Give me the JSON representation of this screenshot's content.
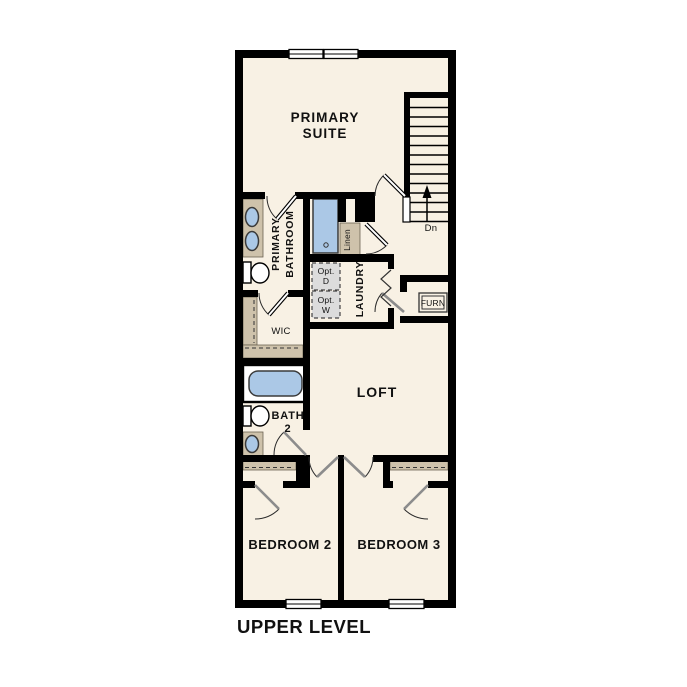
{
  "title": "UPPER LEVEL",
  "colors": {
    "background": "#ffffff",
    "floor": "#f8f1e4",
    "wall": "#000000",
    "counter_tan": "#cec2ab",
    "fixture_blue": "#abc8e6",
    "opt_box_fill": "#dcdcdc",
    "door_leaf_gray": "#8c8c8c"
  },
  "rooms": {
    "primary_suite": {
      "line1": "PRIMARY",
      "line2": "SUITE"
    },
    "primary_bathroom": {
      "line1": "PRIMARY",
      "line2": "BATHROOM"
    },
    "wic": {
      "label": "WIC"
    },
    "laundry": {
      "label": "LAUNDRY"
    },
    "linen": {
      "label": "Linen"
    },
    "loft": {
      "label": "LOFT"
    },
    "bath2": {
      "line1": "BATH",
      "line2": "2"
    },
    "bedroom2": {
      "label": "BEDROOM 2"
    },
    "bedroom3": {
      "label": "BEDROOM 3"
    }
  },
  "fixtures": {
    "opt_dryer": {
      "line1": "Opt.",
      "line2": "D"
    },
    "opt_washer": {
      "line1": "Opt.",
      "line2": "W"
    },
    "furnace": {
      "label": "FURN"
    },
    "stairs_direction": {
      "label": "Dn"
    }
  }
}
